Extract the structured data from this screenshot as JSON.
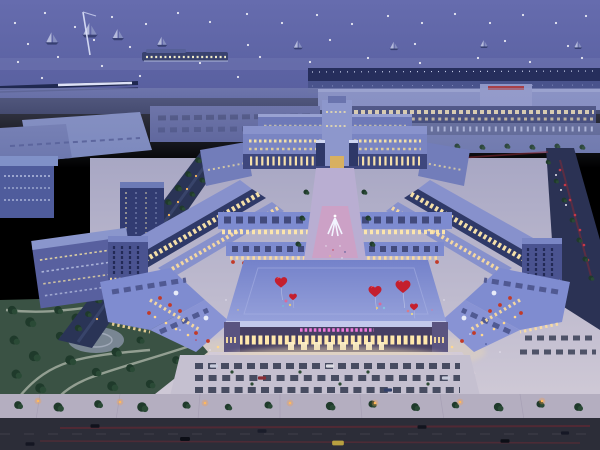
{
  "scene": {
    "description": "Night aerial rendering of a symmetric illuminated commercial plaza complex beside a waterfront pier, with heart-shaped red balloons over the central hall, parks, parking lots and roads with traffic",
    "facade_sign": {
      "color": "#ee79da",
      "text_legible": false
    },
    "palette": {
      "sky_top": "#666cae",
      "sky_bottom": "#585f9f",
      "sea": "#4c5494",
      "sea_dark": "#3b4683",
      "pier": "#262e5c",
      "terminal_wall": "#7e88be",
      "terminal_window": "#f3dfa6",
      "roof_blue": "#7482ca",
      "roof_blue_light": "#95a0da",
      "facade_warm": "#ffe8ac",
      "facade_dark": "#463f63",
      "plaza_light": "#cfc9d6",
      "plaza_shade": "#a8a7c4",
      "axis_pink": "#cf9fc4",
      "park_green": "#3a5244",
      "tree_green": "#1f3a2b",
      "road_dark": "#2c2d38",
      "heart_red": "#c41f2e",
      "awning_red": "#c23a28",
      "lamp_orange": "#ffb85c",
      "taillight_red": "#8a2a34"
    },
    "sky_lights": [
      [
        15,
        23
      ],
      [
        45,
        13
      ],
      [
        75,
        27
      ],
      [
        112,
        17
      ],
      [
        146,
        24
      ],
      [
        178,
        13
      ],
      [
        210,
        22
      ],
      [
        247,
        14
      ],
      [
        282,
        23
      ],
      [
        317,
        15
      ],
      [
        352,
        24
      ],
      [
        388,
        16
      ],
      [
        422,
        23
      ],
      [
        455,
        14
      ],
      [
        490,
        23
      ],
      [
        523,
        15
      ],
      [
        556,
        23
      ],
      [
        586,
        16
      ],
      [
        28,
        44
      ],
      [
        94,
        40
      ],
      [
        130,
        47
      ],
      [
        248,
        45
      ],
      [
        330,
        40
      ],
      [
        415,
        44
      ],
      [
        505,
        41
      ],
      [
        568,
        46
      ],
      [
        18,
        62
      ],
      [
        58,
        57
      ],
      [
        102,
        66
      ],
      [
        152,
        58
      ],
      [
        200,
        63
      ],
      [
        260,
        57
      ],
      [
        310,
        62
      ],
      [
        368,
        58
      ],
      [
        420,
        63
      ],
      [
        478,
        58
      ],
      [
        530,
        62
      ],
      [
        582,
        58
      ],
      [
        42,
        78
      ],
      [
        140,
        76
      ],
      [
        238,
        77
      ],
      [
        336,
        78
      ],
      [
        436,
        76
      ],
      [
        536,
        77
      ]
    ],
    "boats": [
      [
        52,
        40,
        1.1
      ],
      [
        90,
        32,
        1.3
      ],
      [
        118,
        36,
        1.0
      ],
      [
        162,
        43,
        0.9
      ],
      [
        298,
        46,
        0.8
      ],
      [
        394,
        47,
        0.75
      ],
      [
        484,
        45,
        0.7
      ],
      [
        578,
        46,
        0.7
      ]
    ],
    "hearts": [
      [
        281,
        281,
        0.95
      ],
      [
        293,
        296,
        0.6
      ],
      [
        375,
        290,
        1.0
      ],
      [
        403,
        285,
        1.15
      ],
      [
        414,
        306,
        0.62
      ]
    ],
    "balloon_clusters": [
      [
        286,
        301,
        1.5,
        "#d86a9a"
      ],
      [
        290,
        305,
        1.2,
        "#e8c878"
      ],
      [
        283,
        306,
        1.1,
        "#7ab0d8"
      ],
      [
        380,
        304,
        1.5,
        "#d86a9a"
      ],
      [
        384,
        308,
        1.2,
        "#88c0e0"
      ],
      [
        377,
        308,
        1.1,
        "#e8c878"
      ],
      [
        408,
        311,
        1.3,
        "#d87a8a"
      ],
      [
        412,
        314,
        1.1,
        "#e8d890"
      ]
    ],
    "terminal_trees": [
      [
        332,
        147,
        0.8
      ],
      [
        357,
        146,
        0.8
      ],
      [
        382,
        147,
        0.8
      ],
      [
        407,
        146,
        0.8
      ],
      [
        432,
        147,
        0.8
      ],
      [
        457,
        146,
        0.8
      ],
      [
        482,
        147,
        0.8
      ],
      [
        507,
        146,
        0.8
      ],
      [
        532,
        147,
        0.8
      ],
      [
        557,
        146,
        0.8
      ],
      [
        582,
        147,
        0.8
      ]
    ],
    "axis_trees": [
      [
        306,
        192,
        0.8
      ],
      [
        364,
        192,
        0.8
      ],
      [
        302,
        218,
        0.8
      ],
      [
        368,
        218,
        0.8
      ],
      [
        298,
        244,
        0.8
      ],
      [
        372,
        244,
        0.8
      ]
    ],
    "avenue_trees": [
      [
        198,
        160,
        0.9
      ],
      [
        188,
        174,
        0.9
      ],
      [
        178,
        188,
        1.0
      ],
      [
        168,
        202,
        0.9
      ],
      [
        158,
        216,
        1.0
      ],
      [
        148,
        230,
        0.9
      ],
      [
        138,
        244,
        1.0
      ],
      [
        128,
        258,
        0.9
      ],
      [
        118,
        272,
        1.0
      ],
      [
        108,
        286,
        0.9
      ],
      [
        98,
        300,
        1.0
      ],
      [
        88,
        314,
        0.9
      ],
      [
        78,
        328,
        1.0
      ],
      [
        212,
        166,
        0.8
      ],
      [
        202,
        180,
        0.8
      ],
      [
        192,
        194,
        0.8
      ],
      [
        182,
        208,
        0.8
      ],
      [
        172,
        222,
        0.8
      ],
      [
        162,
        236,
        0.8
      ],
      [
        152,
        250,
        0.8
      ],
      [
        142,
        264,
        0.8
      ],
      [
        132,
        278,
        0.8
      ],
      [
        122,
        292,
        0.8
      ],
      [
        112,
        306,
        0.8
      ]
    ],
    "avenue_lights": [
      [
        205,
        163
      ],
      [
        196,
        176
      ],
      [
        187,
        189
      ],
      [
        178,
        202
      ],
      [
        169,
        215
      ],
      [
        160,
        228
      ],
      [
        151,
        241
      ],
      [
        142,
        254
      ],
      [
        133,
        267
      ],
      [
        124,
        280
      ],
      [
        115,
        293
      ],
      [
        106,
        306
      ],
      [
        97,
        319
      ]
    ],
    "park_trees": [
      [
        12,
        310,
        1.3
      ],
      [
        30,
        322,
        1.5
      ],
      [
        14,
        340,
        1.4
      ],
      [
        34,
        356,
        1.6
      ],
      [
        16,
        374,
        1.4
      ],
      [
        40,
        388,
        1.5
      ],
      [
        58,
        310,
        1.2
      ],
      [
        76,
        318,
        1.4
      ],
      [
        60,
        336,
        1.3
      ],
      [
        92,
        334,
        1.2
      ],
      [
        70,
        360,
        1.5
      ],
      [
        96,
        372,
        1.3
      ],
      [
        116,
        352,
        1.4
      ],
      [
        130,
        368,
        1.2
      ],
      [
        112,
        386,
        1.5
      ],
      [
        140,
        340,
        1.1
      ],
      [
        148,
        310,
        1.2
      ],
      [
        168,
        320,
        1.1
      ],
      [
        150,
        384,
        1.3
      ],
      [
        176,
        360,
        1.2
      ]
    ],
    "right_road_trees": [
      [
        548,
        162,
        0.7
      ],
      [
        556,
        181,
        0.7
      ],
      [
        564,
        200,
        0.75
      ],
      [
        572,
        220,
        0.75
      ],
      [
        579,
        240,
        0.8
      ],
      [
        585,
        259,
        0.8
      ],
      [
        591,
        278,
        0.8
      ]
    ],
    "right_road_taillights": [
      [
        560,
        170
      ],
      [
        565,
        185
      ],
      [
        570,
        200
      ],
      [
        575,
        215
      ],
      [
        580,
        230
      ],
      [
        584,
        245
      ],
      [
        588,
        260
      ]
    ],
    "right_road_headlights": [
      [
        556,
        175
      ],
      [
        561,
        190
      ],
      [
        566,
        205
      ]
    ],
    "awnings_left": [
      [
        233,
        262
      ],
      [
        244,
        263
      ],
      [
        255,
        262
      ],
      [
        266,
        263
      ],
      [
        160,
        298
      ],
      [
        170,
        305
      ],
      [
        180,
        311
      ],
      [
        149,
        313
      ],
      [
        208,
        341
      ],
      [
        196,
        333
      ]
    ],
    "awnings_right": [
      [
        437,
        262
      ],
      [
        426,
        263
      ],
      [
        415,
        262
      ],
      [
        404,
        263
      ],
      [
        510,
        298
      ],
      [
        500,
        305
      ],
      [
        490,
        311
      ],
      [
        521,
        313
      ],
      [
        462,
        341
      ],
      [
        474,
        333
      ]
    ],
    "cafe_lights_left": [
      [
        155,
        317
      ],
      [
        166,
        323
      ],
      [
        176,
        329
      ],
      [
        188,
        335
      ],
      [
        218,
        347
      ],
      [
        230,
        352
      ]
    ],
    "cafe_lights_right": [
      [
        515,
        317
      ],
      [
        504,
        323
      ],
      [
        494,
        329
      ],
      [
        482,
        335
      ],
      [
        452,
        347
      ],
      [
        440,
        352
      ]
    ],
    "turret_caps": [
      [
        176,
        293
      ],
      [
        206,
        318
      ],
      [
        494,
        293
      ],
      [
        464,
        318
      ]
    ],
    "crowd_specks": [
      [
        252,
        357,
        0.9,
        "#e8e4f0"
      ],
      [
        259,
        360,
        0.8,
        "#c2394a"
      ],
      [
        266,
        356,
        0.8,
        "#3a4a8c"
      ],
      [
        274,
        359,
        0.9,
        "#e8c878"
      ],
      [
        282,
        357,
        0.8,
        "#e8e4f0"
      ],
      [
        290,
        361,
        0.8,
        "#52b0a2"
      ],
      [
        298,
        358,
        0.9,
        "#d87aa0"
      ],
      [
        306,
        356,
        0.8,
        "#e8e4f0"
      ],
      [
        314,
        360,
        0.8,
        "#3a4a8c"
      ],
      [
        322,
        357,
        0.9,
        "#c2394a"
      ],
      [
        330,
        361,
        0.8,
        "#e8e4f0"
      ],
      [
        338,
        358,
        0.8,
        "#e8c878"
      ],
      [
        346,
        356,
        0.9,
        "#e8e4f0"
      ],
      [
        354,
        360,
        0.8,
        "#52b0a2"
      ],
      [
        362,
        357,
        0.8,
        "#3a4a8c"
      ],
      [
        370,
        361,
        0.9,
        "#e8e4f0"
      ],
      [
        378,
        358,
        0.8,
        "#d87aa0"
      ],
      [
        386,
        356,
        0.8,
        "#c2394a"
      ],
      [
        394,
        360,
        0.9,
        "#e8e4f0"
      ],
      [
        402,
        357,
        0.8,
        "#e8c878"
      ],
      [
        410,
        361,
        0.8,
        "#3a4a8c"
      ],
      [
        418,
        358,
        0.9,
        "#e8e4f0"
      ],
      [
        300,
        368,
        0.8,
        "#e8e4f0"
      ],
      [
        320,
        366,
        0.8,
        "#c2394a"
      ],
      [
        340,
        369,
        0.8,
        "#e8e4f0"
      ],
      [
        360,
        366,
        0.8,
        "#3a4a8c"
      ],
      [
        280,
        367,
        0.8,
        "#e8c878"
      ],
      [
        400,
        368,
        0.8,
        "#e8e4f0"
      ],
      [
        250,
        366,
        0.8,
        "#e8e4f0"
      ],
      [
        430,
        364,
        0.8,
        "#d87aa0"
      ]
    ],
    "axis_crowd": [
      [
        326,
        246,
        0.7,
        "#e8e4f0"
      ],
      [
        333,
        250,
        0.7,
        "#c2394a"
      ],
      [
        340,
        246,
        0.7,
        "#e8e4f0"
      ],
      [
        345,
        252,
        0.7,
        "#3a4a8c"
      ],
      [
        330,
        256,
        0.7,
        "#e8c878"
      ],
      [
        342,
        258,
        0.7,
        "#e8e4f0"
      ]
    ],
    "plaza_crowd": [
      [
        180,
        330,
        0.8,
        "#e8e4f0"
      ],
      [
        196,
        340,
        0.8,
        "#c2394a"
      ],
      [
        210,
        350,
        0.8,
        "#e8e4f0"
      ],
      [
        470,
        334,
        0.8,
        "#e8e4f0"
      ],
      [
        486,
        344,
        0.8,
        "#3a4a8c"
      ],
      [
        500,
        352,
        0.8,
        "#e8e4f0"
      ],
      [
        226,
        300,
        0.7,
        "#e8e4f0"
      ],
      [
        238,
        310,
        0.7,
        "#e8c878"
      ],
      [
        444,
        300,
        0.7,
        "#e8e4f0"
      ],
      [
        432,
        310,
        0.7,
        "#d87aa0"
      ]
    ],
    "hedge_dots": [
      [
        232,
        372,
        1.6
      ],
      [
        300,
        372,
        1.6
      ],
      [
        368,
        372,
        1.6
      ],
      [
        252,
        384,
        1.6
      ],
      [
        340,
        384,
        1.6
      ],
      [
        428,
        384,
        1.6
      ]
    ],
    "parking_cars": [
      [
        214,
        366,
        0.9,
        "#c8ccdc"
      ],
      [
        262,
        378,
        0.9,
        "#8a2e36"
      ],
      [
        330,
        366,
        0.9,
        "#dcdce4"
      ],
      [
        388,
        390,
        0.9,
        "#32406a"
      ],
      [
        446,
        378,
        0.9,
        "#c8ccdc"
      ]
    ],
    "sidewalk_trees": [
      [
        18,
        405,
        1.2
      ],
      [
        58,
        407,
        1.4
      ],
      [
        98,
        404,
        1.2
      ],
      [
        142,
        407,
        1.5
      ],
      [
        186,
        405,
        1.1
      ],
      [
        228,
        407,
        1.0
      ],
      [
        268,
        405,
        1.1
      ],
      [
        330,
        406,
        1.3
      ],
      [
        372,
        404,
        1.1
      ],
      [
        415,
        407,
        1.2
      ],
      [
        455,
        405,
        1.0
      ],
      [
        498,
        407,
        1.3
      ],
      [
        540,
        404,
        1.1
      ],
      [
        578,
        407,
        1.2
      ]
    ],
    "street_lamps": [
      [
        38,
        401,
        1
      ],
      [
        120,
        402,
        1
      ],
      [
        205,
        403,
        1
      ],
      [
        290,
        403,
        1
      ],
      [
        375,
        403,
        1
      ],
      [
        460,
        402,
        1
      ],
      [
        542,
        401,
        1
      ]
    ],
    "road_cars": [
      [
        95,
        426,
        1,
        "#10121c"
      ],
      [
        185,
        439,
        1.1,
        "#0c0e16"
      ],
      [
        262,
        431,
        1,
        "#1a1d2a"
      ],
      [
        338,
        443,
        1.3,
        "#b8a040"
      ],
      [
        422,
        427,
        1,
        "#12141e"
      ],
      [
        505,
        441,
        1,
        "#0c0e16"
      ],
      [
        565,
        433,
        0.9,
        "#161826"
      ],
      [
        30,
        444,
        1,
        "#141622"
      ]
    ]
  }
}
